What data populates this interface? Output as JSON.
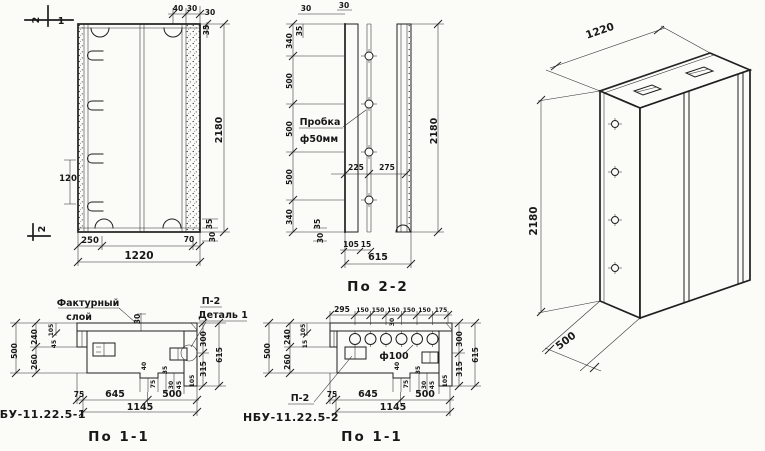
{
  "drawing": {
    "colors": {
      "paper": "#fbfbf8",
      "ink": "#1f1f1f"
    },
    "front": {
      "section_marks": {
        "top_num": "2",
        "top_ref": "1",
        "left_num": "2"
      },
      "dims": {
        "height": "2180",
        "width": "1220",
        "bottom_left": "250",
        "bottom_right": "70",
        "hook_spacing": "120",
        "top_small": [
          "40",
          "30",
          "30"
        ],
        "top_right_rot": "35",
        "bottom_right_rot": [
          "35",
          "30"
        ]
      }
    },
    "section22": {
      "caption": "По 2-2",
      "plug_label": [
        "Пробка",
        "ф50мм"
      ],
      "dims": {
        "left": [
          "340",
          "500",
          "500",
          "500",
          "340"
        ],
        "plug_offsets": [
          "225",
          "275"
        ],
        "top_small": [
          "30",
          "35",
          "30"
        ],
        "bottom_small": [
          "35",
          "30",
          "105",
          "15"
        ],
        "width": "615",
        "height": "2180"
      }
    },
    "iso": {
      "dims": {
        "width": "1220",
        "height": "2180",
        "depth": "500"
      }
    },
    "plan1": {
      "caption": "По 1-1",
      "title": "НБУ-11.22.5-1",
      "labels": {
        "layer_1": "Фактурный",
        "layer_2": "слой",
        "detail_ref": "П-2",
        "detail": "Деталь 1"
      },
      "dims": {
        "left": [
          "500",
          "240",
          "260"
        ],
        "left_small": [
          "105",
          "45"
        ],
        "layer_thickness": "30",
        "right": [
          "300",
          "315",
          "615"
        ],
        "notch": [
          "40",
          "75",
          "35",
          "30",
          "45",
          "105"
        ],
        "bottom": [
          "75",
          "645",
          "500"
        ],
        "bottom_total": "1145"
      }
    },
    "plan2": {
      "caption": "По 1-1",
      "title": "НБУ-11.22.5-2",
      "labels": {
        "hole": "ф100",
        "detail_ref": "П-2"
      },
      "dims": {
        "top": [
          "295",
          "150",
          "150",
          "150",
          "150",
          "150",
          "175"
        ],
        "top_small": "30",
        "left": [
          "500",
          "240",
          "260"
        ],
        "left_small": [
          "105",
          "15"
        ],
        "right": [
          "300",
          "315",
          "615"
        ],
        "notch": [
          "40",
          "75",
          "35",
          "30",
          "45",
          "105"
        ],
        "bottom": [
          "75",
          "645",
          "500"
        ],
        "bottom_total": "1145"
      }
    }
  }
}
